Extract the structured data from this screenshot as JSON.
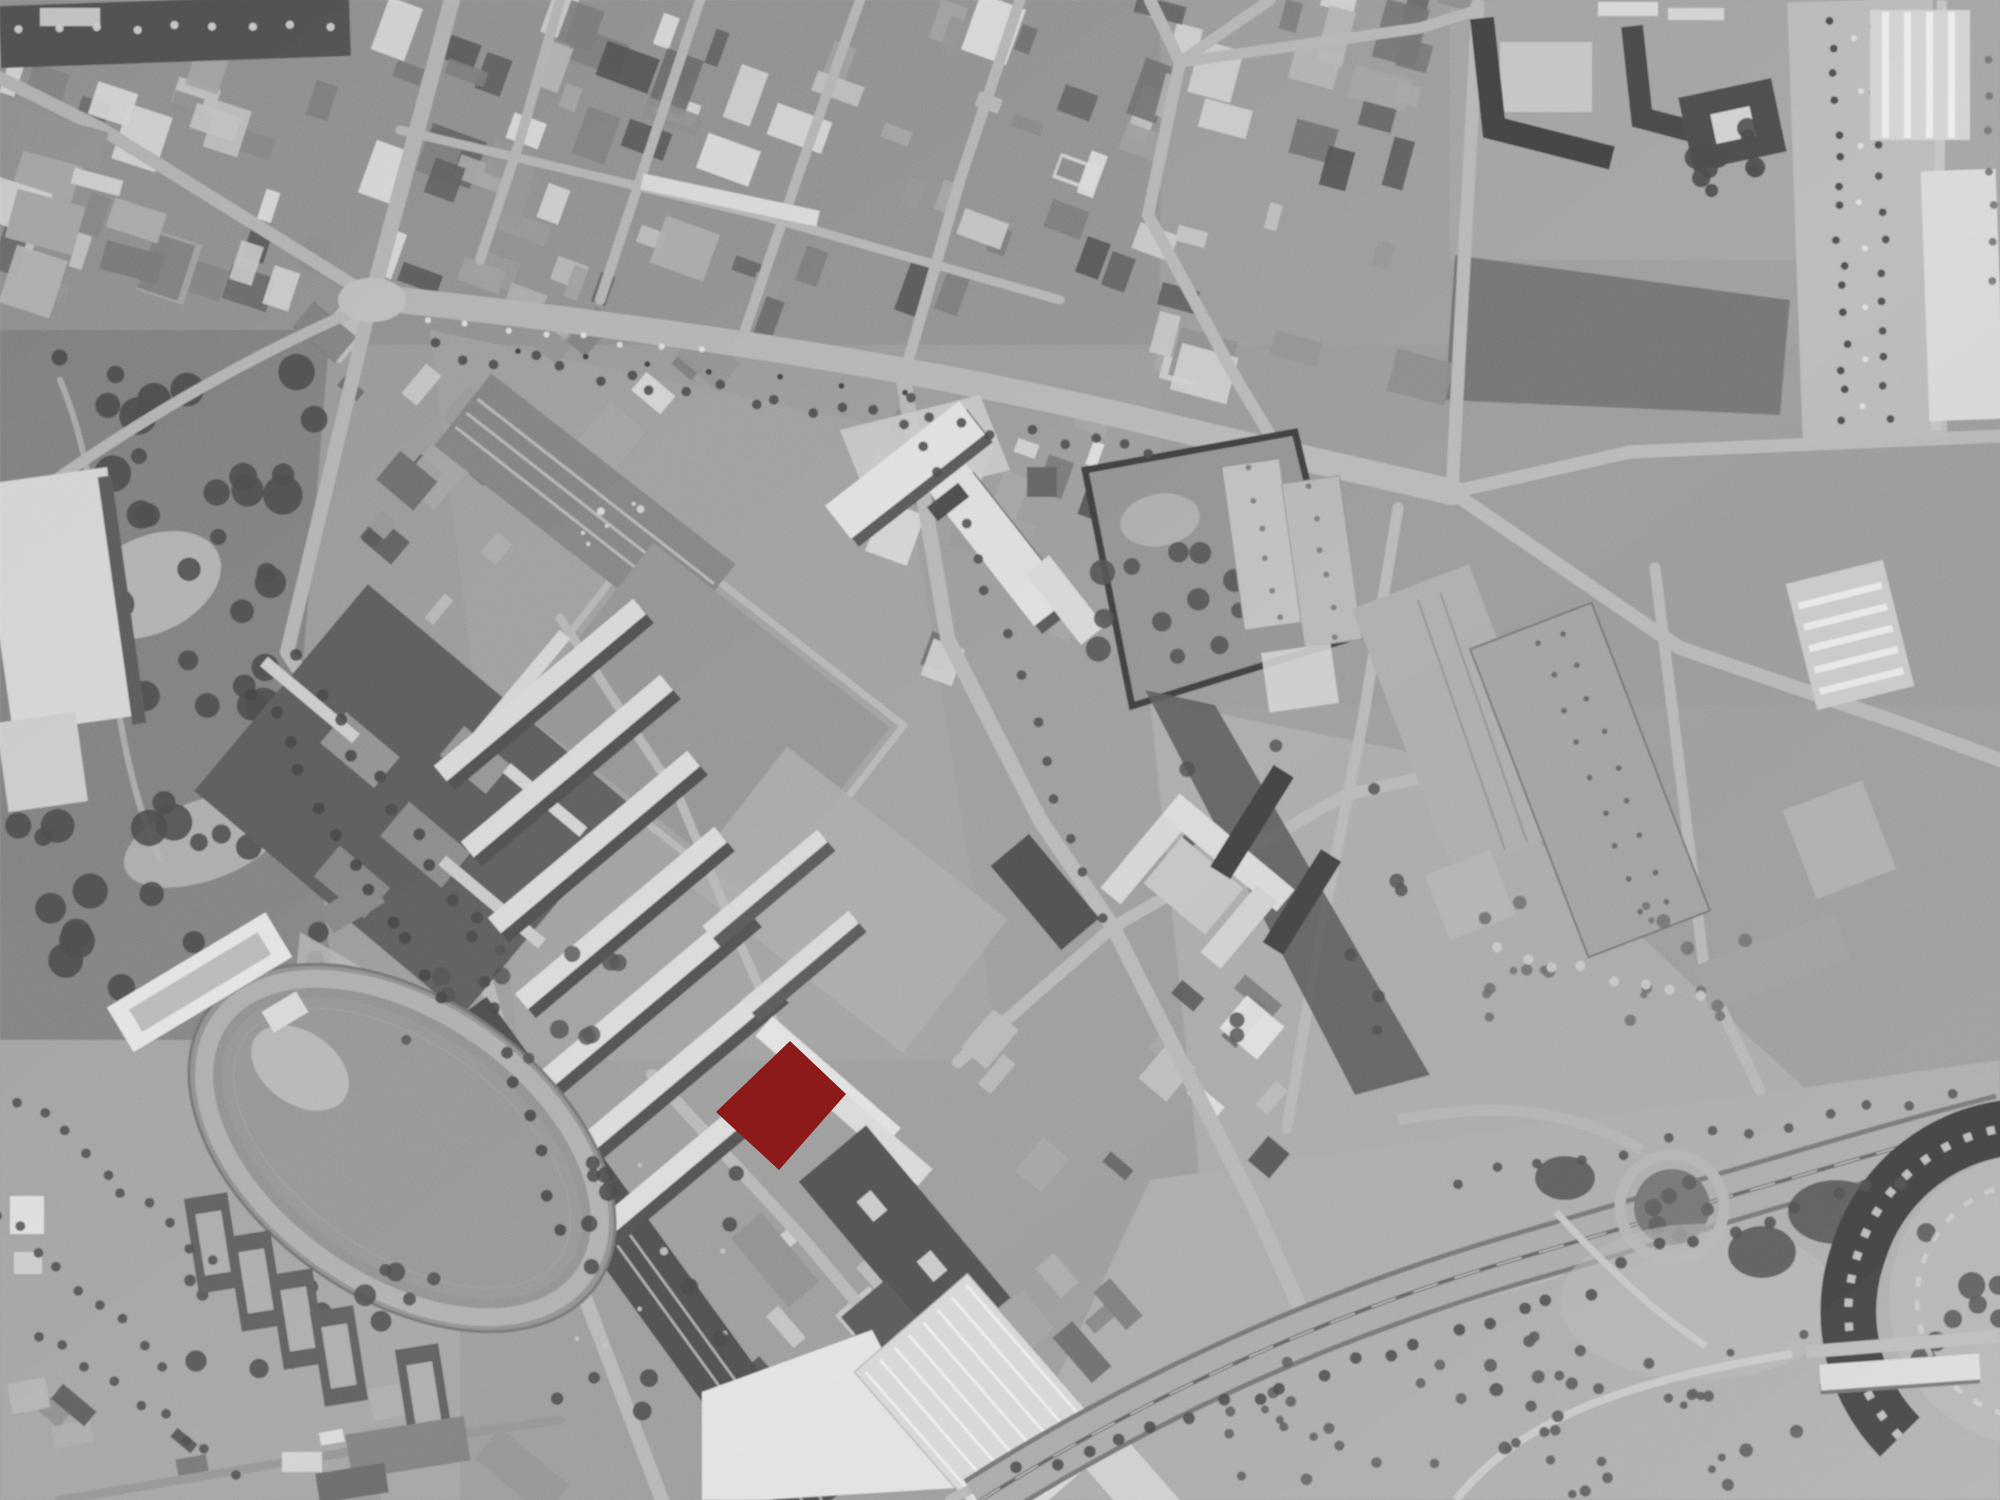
{
  "map": {
    "kind": "aerial-orthophoto",
    "style": "grayscale",
    "highlight": {
      "name": "highlighted-parcel",
      "color": "#8B1A18",
      "opacity": "1",
      "points": "790,1041 846,1094 779,1170 716,1112"
    },
    "features": [
      "athletics-track",
      "tennis-courts",
      "swimming-pool",
      "city-park",
      "residential-superblock",
      "terraced-housing-rows",
      "school-complex",
      "sports-fields",
      "walled-compound",
      "industrial-sheds",
      "parking-lot",
      "railway-cutting",
      "motorway",
      "motorway-loop-ramp",
      "orchard-grove",
      "circular-building",
      "white-roofed-warehouse",
      "dense-urban-fabric",
      "main-avenue",
      "street-grid"
    ]
  },
  "palette": {
    "base": "#979797",
    "park": "#7d7d7d",
    "field": "#9c9c9c",
    "open": "#a8a8a8",
    "road": "#b4b4b4",
    "road_dark": "#8f8f8f",
    "rail": "#4d4d4d",
    "tree": "#4a4a4a",
    "building_light": "#dcdcdc",
    "building_dark": "#4f4f4f",
    "highlight": "#8B1A18"
  }
}
